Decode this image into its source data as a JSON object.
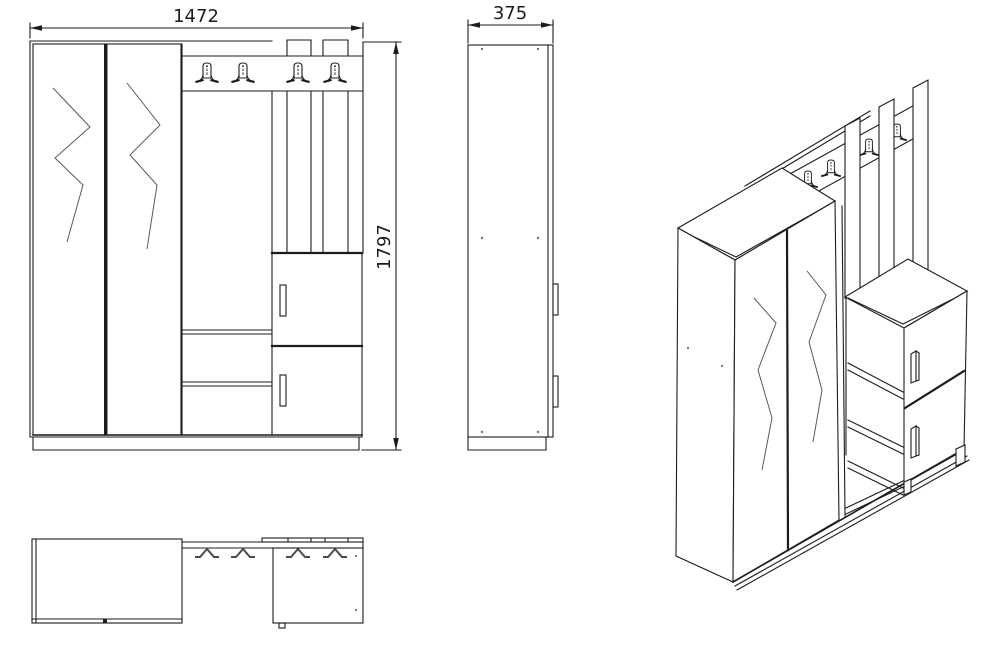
{
  "drawing": {
    "type": "furniture-technical-drawing",
    "background_color": "#ffffff",
    "line_color": "#1c1c1c",
    "detail_line_color": "#5a5a5a",
    "dimensions": {
      "width": "1472",
      "depth": "375",
      "height": "1797"
    },
    "views": {
      "front": "front elevation with wardrobe, open shelves, hook panel and shoe cabinet",
      "side": "side elevation",
      "top": "top plan view",
      "perspective": "isometric perspective view"
    },
    "features": {
      "coat_hooks_front_view": 4,
      "coat_hooks_top_view": 4,
      "coat_hooks_perspective_view": 4,
      "mirror_doors": 2,
      "cabinet_doors": 2,
      "shelves": 2,
      "wall_slats": 3
    },
    "icons": {
      "hook_front": "coat-hook-icon",
      "hook_top": "coat-hook-top-icon",
      "dimension_arrow": "dimension-arrowhead-icon"
    }
  }
}
